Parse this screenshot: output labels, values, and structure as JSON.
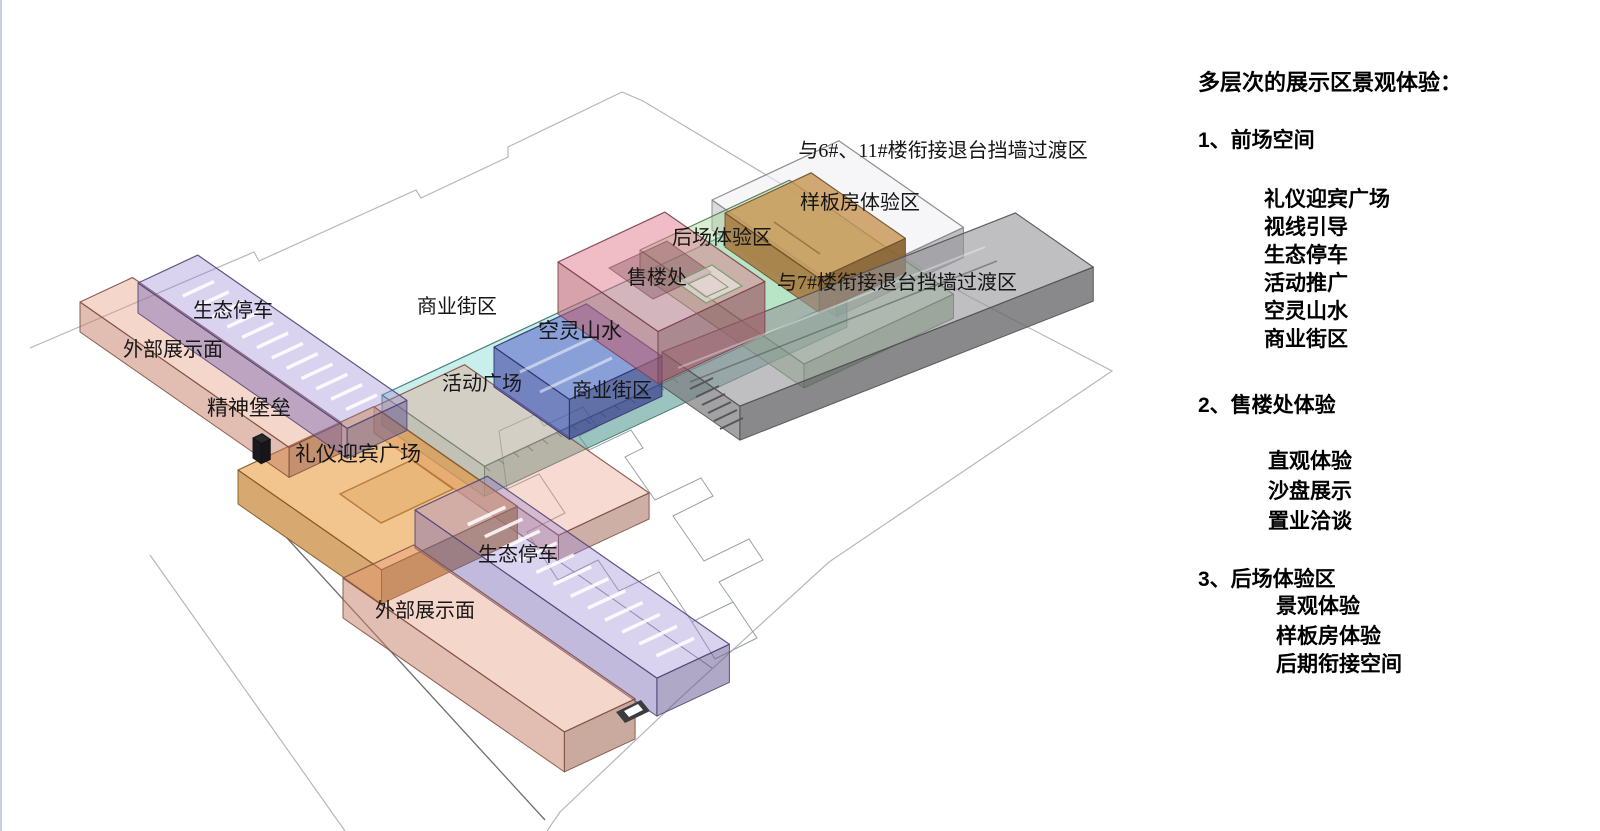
{
  "page": {
    "background": "#ffffff",
    "left_edge_line_color": "#c9cede"
  },
  "diagram": {
    "axes": {
      "u": [
        0.906,
        -0.423
      ],
      "v": [
        0.82,
        0.57
      ]
    },
    "zones": [
      {
        "name": "transition-zone-6-11",
        "zone_label": "与6#、11#楼衔接退台挡墙过渡区",
        "base": [
          238,
          238,
          243
        ],
        "alpha": 0.55,
        "p0": [
          712,
          200
        ],
        "lu": 140,
        "wv": 152,
        "h": 30
      },
      {
        "name": "commercial-street-strip",
        "zone_label": "商业街区",
        "base": [
          110,
          212,
          202
        ],
        "alpha": 0.38,
        "p0": [
          382,
          395
        ],
        "lu": 400,
        "wv": 125,
        "h": 30
      },
      {
        "name": "backyard-experience-zone",
        "zone_label": "后场体验区",
        "base": [
          162,
          214,
          148
        ],
        "alpha": 0.42,
        "p0": [
          640,
          250
        ],
        "lu": 165,
        "wv": 200,
        "h": 24
      },
      {
        "name": "model-house-zone",
        "zone_label": "样板房体验区",
        "base": [
          198,
          146,
          78
        ],
        "alpha": 0.78,
        "p0": [
          725,
          213
        ],
        "lu": 95,
        "wv": 115,
        "h": 34
      },
      {
        "name": "transition-zone-7",
        "zone_label": "与7#楼衔接退台挡墙过渡区",
        "base": [
          148,
          148,
          153
        ],
        "alpha": 0.6,
        "p0": [
          662,
          352
        ],
        "lu": 380,
        "wv": 95,
        "h": 34,
        "u": [
          0.93,
          -0.366
        ]
      },
      {
        "name": "activity-plaza",
        "zone_label": "活动广场",
        "base": [
          231,
          148,
          124
        ],
        "alpha": 0.35,
        "p0": [
          374,
          407
        ],
        "lu": 100,
        "wv": 225,
        "h": 26
      },
      {
        "name": "ethereal-landscape",
        "zone_label": "空灵山水",
        "base": [
          84,
          92,
          200
        ],
        "alpha": 0.55,
        "p0": [
          494,
          347
        ],
        "lu": 102,
        "wv": 92,
        "h": 40
      },
      {
        "name": "sales-office",
        "zone_label": "售楼处",
        "base": [
          224,
          118,
          138
        ],
        "alpha": 0.48,
        "p0": [
          558,
          262
        ],
        "lu": 118,
        "wv": 122,
        "h": 52
      },
      {
        "name": "welcome-plaza",
        "zone_label": "礼仪迎宾广场",
        "base": [
          234,
          158,
          66
        ],
        "alpha": 0.6,
        "p0": [
          238,
          470
        ],
        "lu": 150,
        "wv": 175,
        "h": 34
      },
      {
        "name": "outer-display-upper",
        "zone_label": "外部展示面",
        "base": [
          230,
          148,
          118
        ],
        "alpha": 0.38,
        "p0": [
          80,
          302
        ],
        "lu": 58,
        "wv": 255,
        "h": 30
      },
      {
        "name": "eco-parking-upper",
        "zone_label": "生态停车",
        "base": [
          148,
          128,
          212
        ],
        "alpha": 0.35,
        "p0": [
          138,
          283
        ],
        "lu": 66,
        "wv": 255,
        "h": 30,
        "stalls": true
      },
      {
        "name": "spirit-totem",
        "zone_label": "精神堡垒",
        "base": [
          32,
          32,
          36
        ],
        "alpha": 0.95,
        "p0": [
          253,
          438
        ],
        "lu": 10,
        "wv": 10,
        "h": 20
      },
      {
        "name": "eco-parking-lower",
        "zone_label": "生态停车",
        "base": [
          148,
          128,
          212
        ],
        "alpha": 0.35,
        "p0": [
          415,
          510
        ],
        "lu": 80,
        "wv": 295,
        "h": 38,
        "stalls": true
      },
      {
        "name": "outer-display-lower",
        "zone_label": "外部展示面",
        "base": [
          230,
          148,
          118
        ],
        "alpha": 0.38,
        "p0": [
          343,
          578
        ],
        "lu": 78,
        "wv": 270,
        "h": 40
      }
    ],
    "labels": [
      {
        "id": "label-transition-6-11",
        "text": "与6#、11#楼衔接退台挡墙过渡区",
        "x": 943,
        "y": 157,
        "fs": 20
      },
      {
        "id": "label-model-house",
        "text": "样板房体验区",
        "x": 860,
        "y": 209,
        "fs": 20
      },
      {
        "id": "label-backyard",
        "text": "后场体验区",
        "x": 722,
        "y": 244,
        "fs": 20
      },
      {
        "id": "label-sales-office",
        "text": "售楼处",
        "x": 657,
        "y": 284,
        "fs": 20
      },
      {
        "id": "label-transition-7",
        "text": "与7#楼衔接退台挡墙过渡区",
        "x": 897,
        "y": 289,
        "fs": 20
      },
      {
        "id": "label-commercial-upper",
        "text": "商业街区",
        "x": 457,
        "y": 313,
        "fs": 20
      },
      {
        "id": "label-ethereal",
        "text": "空灵山水",
        "x": 580,
        "y": 338,
        "fs": 21
      },
      {
        "id": "label-activity-plaza",
        "text": "活动广场",
        "x": 482,
        "y": 390,
        "fs": 20
      },
      {
        "id": "label-commercial-lower",
        "text": "商业街区",
        "x": 612,
        "y": 397,
        "fs": 20
      },
      {
        "id": "label-parking-upper",
        "text": "生态停车",
        "x": 233,
        "y": 317,
        "fs": 20
      },
      {
        "id": "label-display-upper",
        "text": "外部展示面",
        "x": 173,
        "y": 356,
        "fs": 20
      },
      {
        "id": "label-spirit-totem",
        "text": "精神堡垒",
        "x": 249,
        "y": 415,
        "fs": 21
      },
      {
        "id": "label-welcome-plaza",
        "text": "礼仪迎宾广场",
        "x": 358,
        "y": 461,
        "fs": 21
      },
      {
        "id": "label-parking-lower",
        "text": "生态停车",
        "x": 518,
        "y": 561,
        "fs": 20
      },
      {
        "id": "label-display-lower",
        "text": "外部展示面",
        "x": 425,
        "y": 617,
        "fs": 20
      }
    ],
    "plan_under": [
      {
        "id": "site-boundary",
        "d": "M 30 348 L 254 252 L 259 261 L 416 190 L 421 198 L 508 157 L 508 147 L 622 92 L 643 101 L 968 296 L 1112 371 L 829 562 L 678 700 L 560 812 L 547 831",
        "stroke": "#b6b6be",
        "w": 1.2
      },
      {
        "id": "site-boundary-left",
        "d": "M 150 555 L 345 831",
        "stroke": "#b6b6be",
        "w": 1.2
      },
      {
        "id": "site-edge-dark",
        "d": "M 287 538 L 545 820",
        "stroke": "#6e6e74",
        "w": 1.3
      },
      {
        "id": "site-edge-lower",
        "d": "M 478 505 L 712 668",
        "stroke": "#8a8a92",
        "w": 1
      },
      {
        "id": "building-footprint",
        "d": "M 499 431 L 536 414 L 544 426 L 583 407 L 597 427 L 579 436 L 589 450 L 631 430 L 643 448 L 625 457 L 655 500 L 701 478 L 713 496 L 673 516 L 704 561 L 749 539 L 763 560 L 719 582 L 733 602 L 692 622 L 659 572 L 619 591 L 598 560 L 558 580 L 527 532 L 565 513 L 539 474 L 507 489 Z",
        "stroke": "#9aa0a4",
        "w": 1
      },
      {
        "id": "building-footprint-2",
        "d": "M 733 602 L 757 638 L 715 659 L 692 622",
        "stroke": "#9aa0a4",
        "w": 1
      },
      {
        "id": "arcade-ticks",
        "d": "M 484 466 l 6 5 M 498 459 l 6 5 M 513 452 l 6 5 M 527 446 l 6 5 M 542 439 l 6 5 M 556 432 l 6 5 M 571 425 l 6 5 M 585 419 l 6 5 M 600 412 l 6 5 M 614 405 l 6 5 M 629 398 l 6 5 M 643 392 l 6 5 M 658 385 l 6 5 M 672 378 l 6 5",
        "stroke": "#61666a",
        "w": 1
      }
    ],
    "plan_over": [
      {
        "id": "plaza-pool",
        "d": "M 340 494 L 412 460 L 453 489 L 381 523 Z",
        "stroke": "rgba(170,105,35,0.75)",
        "w": 1.5,
        "fill": "rgba(205,135,55,0.22)"
      },
      {
        "id": "sales-office-void",
        "d": "M 609 268 L 667 241 L 711 272 L 653 299 Z",
        "stroke": "rgba(125,55,70,0.55)",
        "w": 1,
        "fill": "rgba(95,45,58,0.30)"
      },
      {
        "id": "backyard-court-outer",
        "d": "M 676 282 L 712 265 L 742 286 L 706 303 Z",
        "stroke": "#79a06c",
        "w": 1.2,
        "fill": "rgba(255,255,255,0.45)"
      },
      {
        "id": "backyard-court-inner",
        "d": "M 688 284 L 710 274 L 728 287 L 706 297 Z",
        "stroke": "#79a06c",
        "w": 1,
        "fill": "none"
      },
      {
        "id": "water-paths",
        "d": "M 520 372 L 592 338 M 540 392 L 612 358",
        "stroke": "rgba(255,255,255,0.5)",
        "w": 3
      },
      {
        "id": "gray-corridor-dark",
        "d": "M 690 382 L 997 261",
        "stroke": "rgba(70,70,76,0.5)",
        "w": 1.5
      },
      {
        "id": "gray-corridor-light",
        "d": "M 678 368 L 985 247",
        "stroke": "rgba(255,255,255,0.35)",
        "w": 2
      },
      {
        "id": "model-house-lines",
        "d": "M 752 232 L 798 264 M 774 222 L 820 254",
        "stroke": "rgba(125,85,45,0.6)",
        "w": 1.5
      },
      {
        "id": "steps",
        "d": "M 690 389 L 713 378 M 696 397 L 719 386 M 702 405 L 725 394 M 708 413 L 731 402 M 714 421 L 737 410 M 720 429 L 743 418",
        "stroke": "#55565a",
        "w": 2
      },
      {
        "id": "ramp-slot-dark",
        "d": "M 616 712 L 641 700 L 650 711 L 625 723 Z",
        "stroke": "none",
        "w": 0,
        "fill": "#3c3c40"
      },
      {
        "id": "ramp-slot-light",
        "d": "M 624 711 L 638 704 L 643 710 L 629 717 Z",
        "stroke": "none",
        "w": 0,
        "fill": "#ffffff"
      }
    ]
  },
  "panel": {
    "title": {
      "text": "多层次的展示区景观体验：",
      "x": 1198,
      "y": 72,
      "fs": 22
    },
    "item_fs": 21,
    "sections": [
      {
        "heading": {
          "text": "1、前场空间",
          "x": 1198,
          "y": 130,
          "fs": 21
        },
        "items": [
          {
            "text": "礼仪迎宾广场",
            "x": 1264,
            "y": 189
          },
          {
            "text": "视线引导",
            "x": 1264,
            "y": 217
          },
          {
            "text": "生态停车",
            "x": 1264,
            "y": 245
          },
          {
            "text": "活动推广",
            "x": 1264,
            "y": 273
          },
          {
            "text": "空灵山水",
            "x": 1264,
            "y": 301
          },
          {
            "text": "商业街区",
            "x": 1264,
            "y": 329
          }
        ]
      },
      {
        "heading": {
          "text": "2、售楼处体验",
          "x": 1198,
          "y": 395,
          "fs": 21
        },
        "items": [
          {
            "text": "直观体验",
            "x": 1268,
            "y": 451
          },
          {
            "text": "沙盘展示",
            "x": 1268,
            "y": 481
          },
          {
            "text": "置业洽谈",
            "x": 1268,
            "y": 511
          }
        ]
      },
      {
        "heading": {
          "text": "3、后场体验区",
          "x": 1198,
          "y": 569,
          "fs": 21
        },
        "items": [
          {
            "text": "景观体验",
            "x": 1276,
            "y": 596
          },
          {
            "text": "样板房体验",
            "x": 1276,
            "y": 626
          },
          {
            "text": "后期衔接空间",
            "x": 1276,
            "y": 654
          }
        ]
      }
    ]
  }
}
